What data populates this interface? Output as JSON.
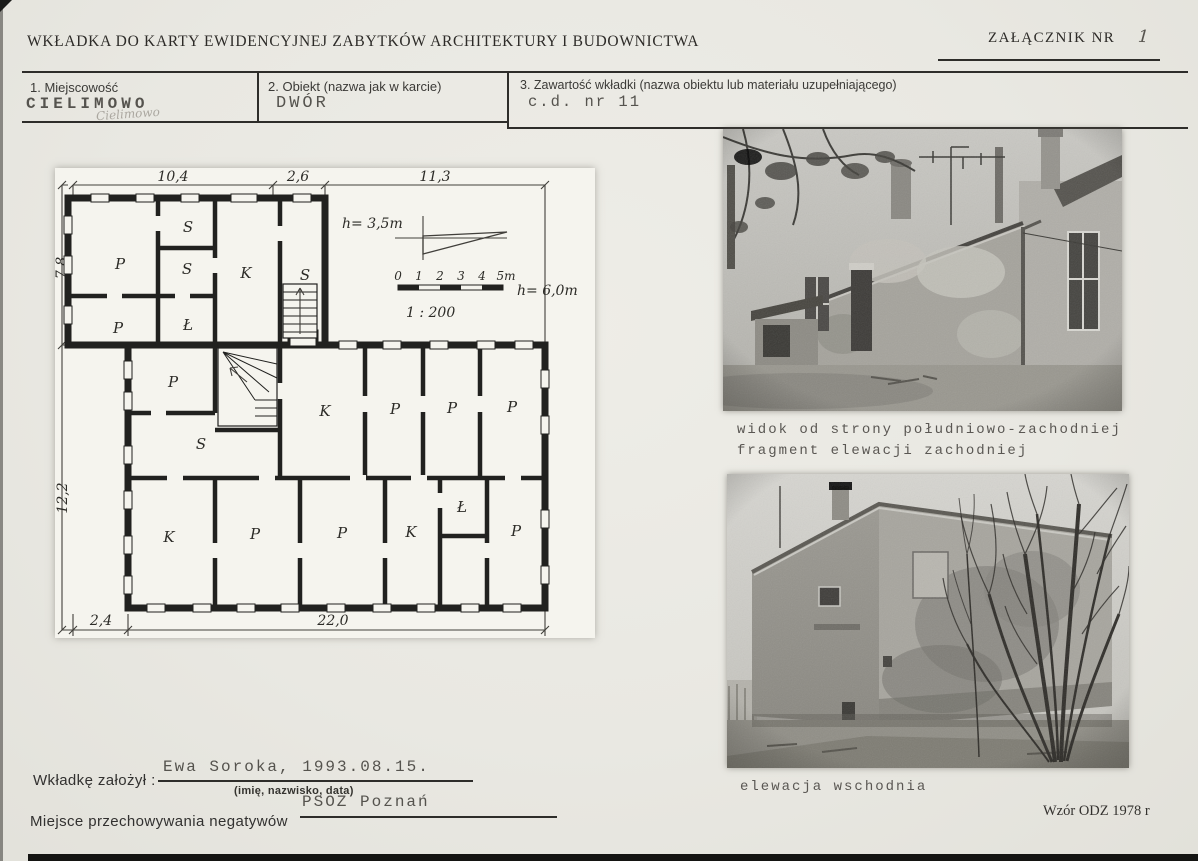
{
  "header": {
    "title": "WKŁADKA DO KARTY EWIDENCYJNEJ ZABYTKÓW ARCHITEKTURY I BUDOWNICTWA",
    "attachment_label": "ZAŁĄCZNIK NR",
    "attachment_number": "1"
  },
  "fields": [
    {
      "label": "1.  Miejscowość",
      "value": "CIELIMOWO",
      "pencil_annotation": "Cielimowo"
    },
    {
      "label": "2.  Obiekt (nazwa jak w karcie)",
      "value": "DWÓR"
    },
    {
      "label": "3.  Zawartość wkładki (nazwa obiektu lub materiału uzupełniającego)",
      "value": "c.d. nr 11"
    }
  ],
  "floor_plan": {
    "dims": {
      "top_left": "10,4",
      "top_mid": "2,6",
      "top_right": "11,3",
      "left_upper": "7,8",
      "left_lower": "12,2",
      "bottom_left": "2,4",
      "bottom_main": "22,0"
    },
    "heights": {
      "upper_wing": "h= 3,5m",
      "lower_wing": "h= 6,0m"
    },
    "scale": {
      "ratio": "1 : 200",
      "ticks": [
        "0",
        "1",
        "2",
        "3",
        "4",
        "5m"
      ]
    },
    "rooms": [
      {
        "label": "P"
      },
      {
        "label": "S"
      },
      {
        "label": "S"
      },
      {
        "label": "K"
      },
      {
        "label": "S"
      },
      {
        "label": "P"
      },
      {
        "label": "Ł"
      },
      {
        "label": "P"
      },
      {
        "label": "S"
      },
      {
        "label": "K"
      },
      {
        "label": "P"
      },
      {
        "label": "P"
      },
      {
        "label": "P"
      },
      {
        "label": "K"
      },
      {
        "label": "P"
      },
      {
        "label": "P"
      },
      {
        "label": "K"
      },
      {
        "label": "Ł"
      },
      {
        "label": "P"
      }
    ]
  },
  "photos": [
    {
      "caption_line1": "widok od strony południowo-zachodniej",
      "caption_line2": "fragment elewacji zachodniej"
    },
    {
      "caption_line1": "elewacja wschodnia"
    }
  ],
  "footer": {
    "founder_label": "Wkładkę założył :",
    "founder_value": "Ewa Soroka, 1993.08.15.",
    "founder_hint": "(imię, nazwisko, data)",
    "negatives_value": "PSOZ Poznań",
    "negatives_label": "Miejsce przechowywania negatywów",
    "form_note": "Wzór ODZ 1978 r"
  }
}
